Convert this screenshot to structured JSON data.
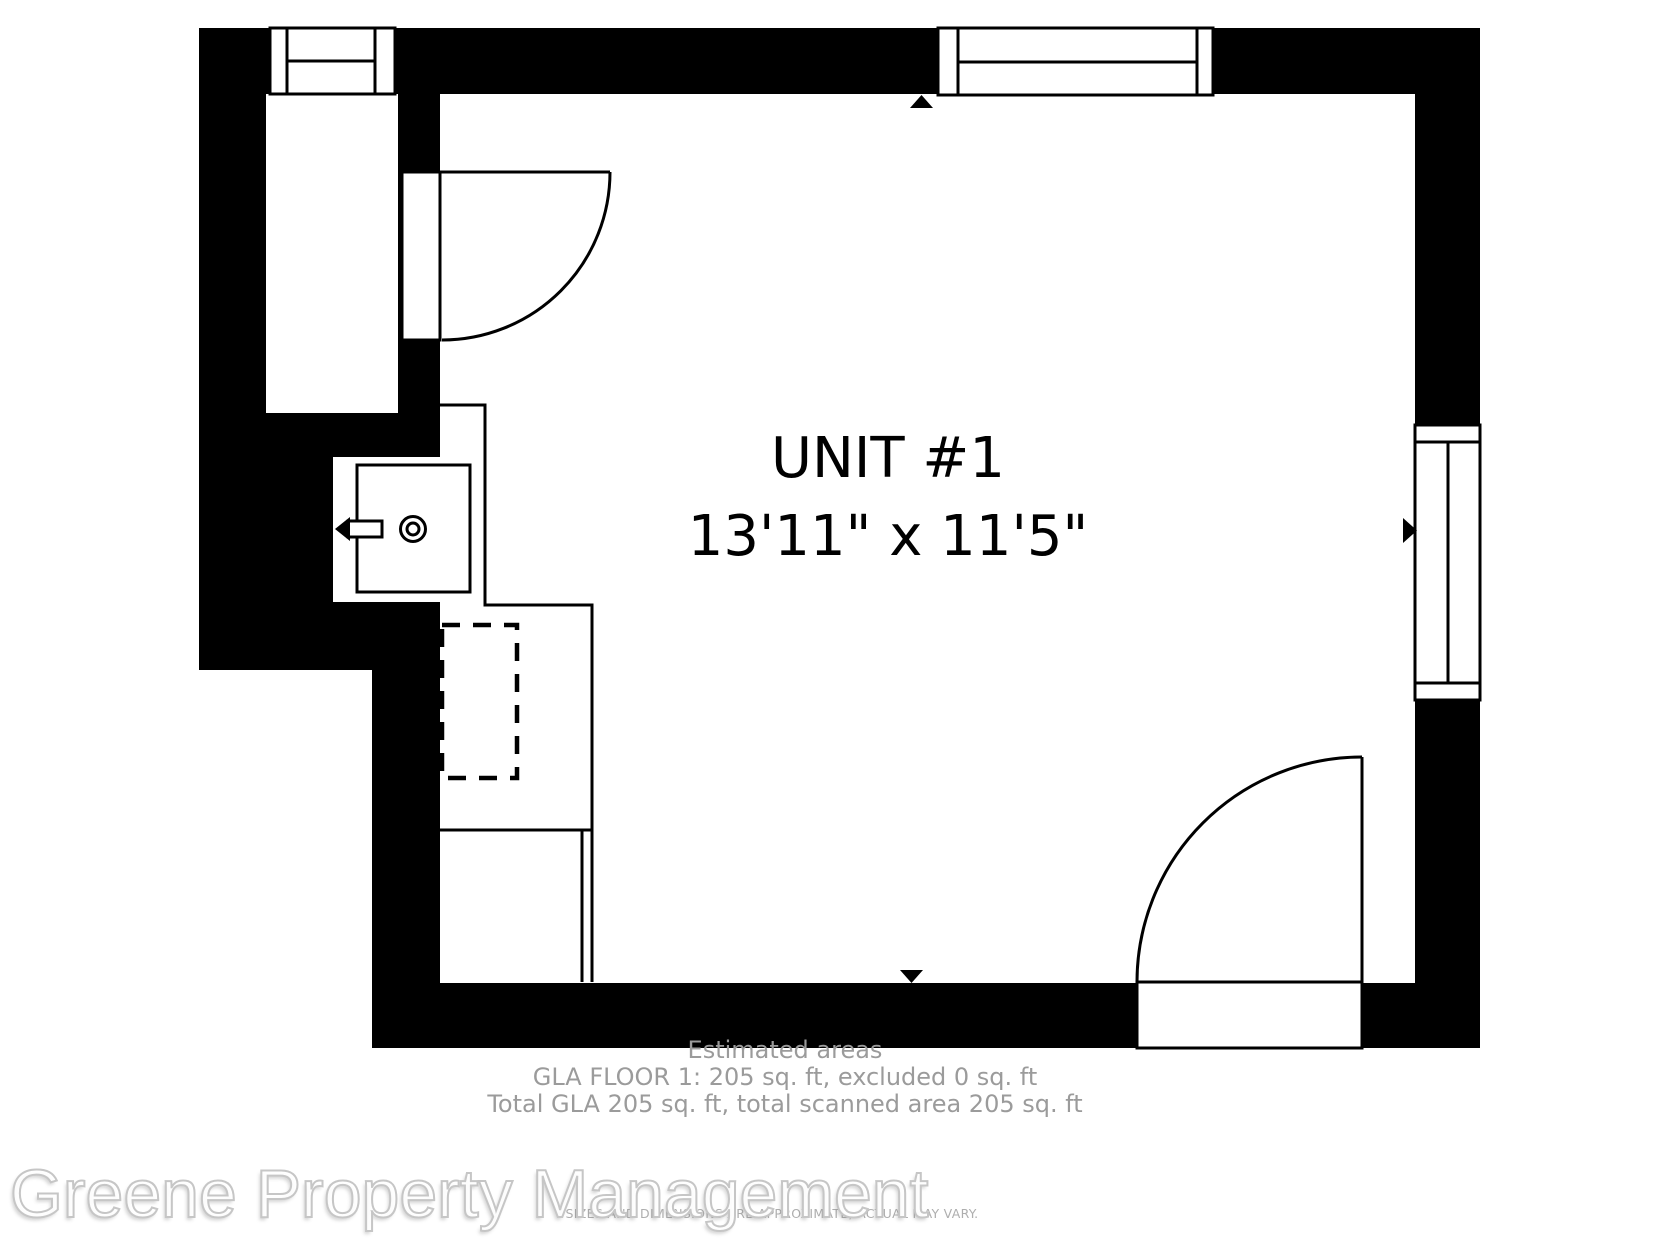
{
  "floorplan": {
    "unit_label": "UNIT #1",
    "unit_dimensions": "13'11\" x 11'5\"",
    "features": {
      "windows": [
        "top-left-window",
        "top-right-window",
        "right-window"
      ],
      "doors": [
        "closet-door",
        "entry-door"
      ],
      "fixtures": [
        "kitchen-sink",
        "faucet",
        "counter",
        "dashed-appliance",
        "lower-cabinet"
      ],
      "markers": [
        "top-wall-marker",
        "bottom-wall-marker",
        "right-wall-marker"
      ]
    },
    "colors": {
      "wall": "#000000",
      "background": "#ffffff"
    }
  },
  "footer": {
    "estimated_areas_title": "Estimated areas",
    "gla_floor_line": "GLA FLOOR 1: 205 sq. ft, excluded 0 sq. ft",
    "total_gla_line": "Total GLA 205 sq. ft, total scanned area 205 sq. ft",
    "disclaimer": "SIZES AND DIMENSIONS ARE APPROXIMATE, ACTUAL MAY VARY.",
    "text_color": "#9b9b9b"
  },
  "watermark": {
    "text": "Greene Property Management"
  }
}
